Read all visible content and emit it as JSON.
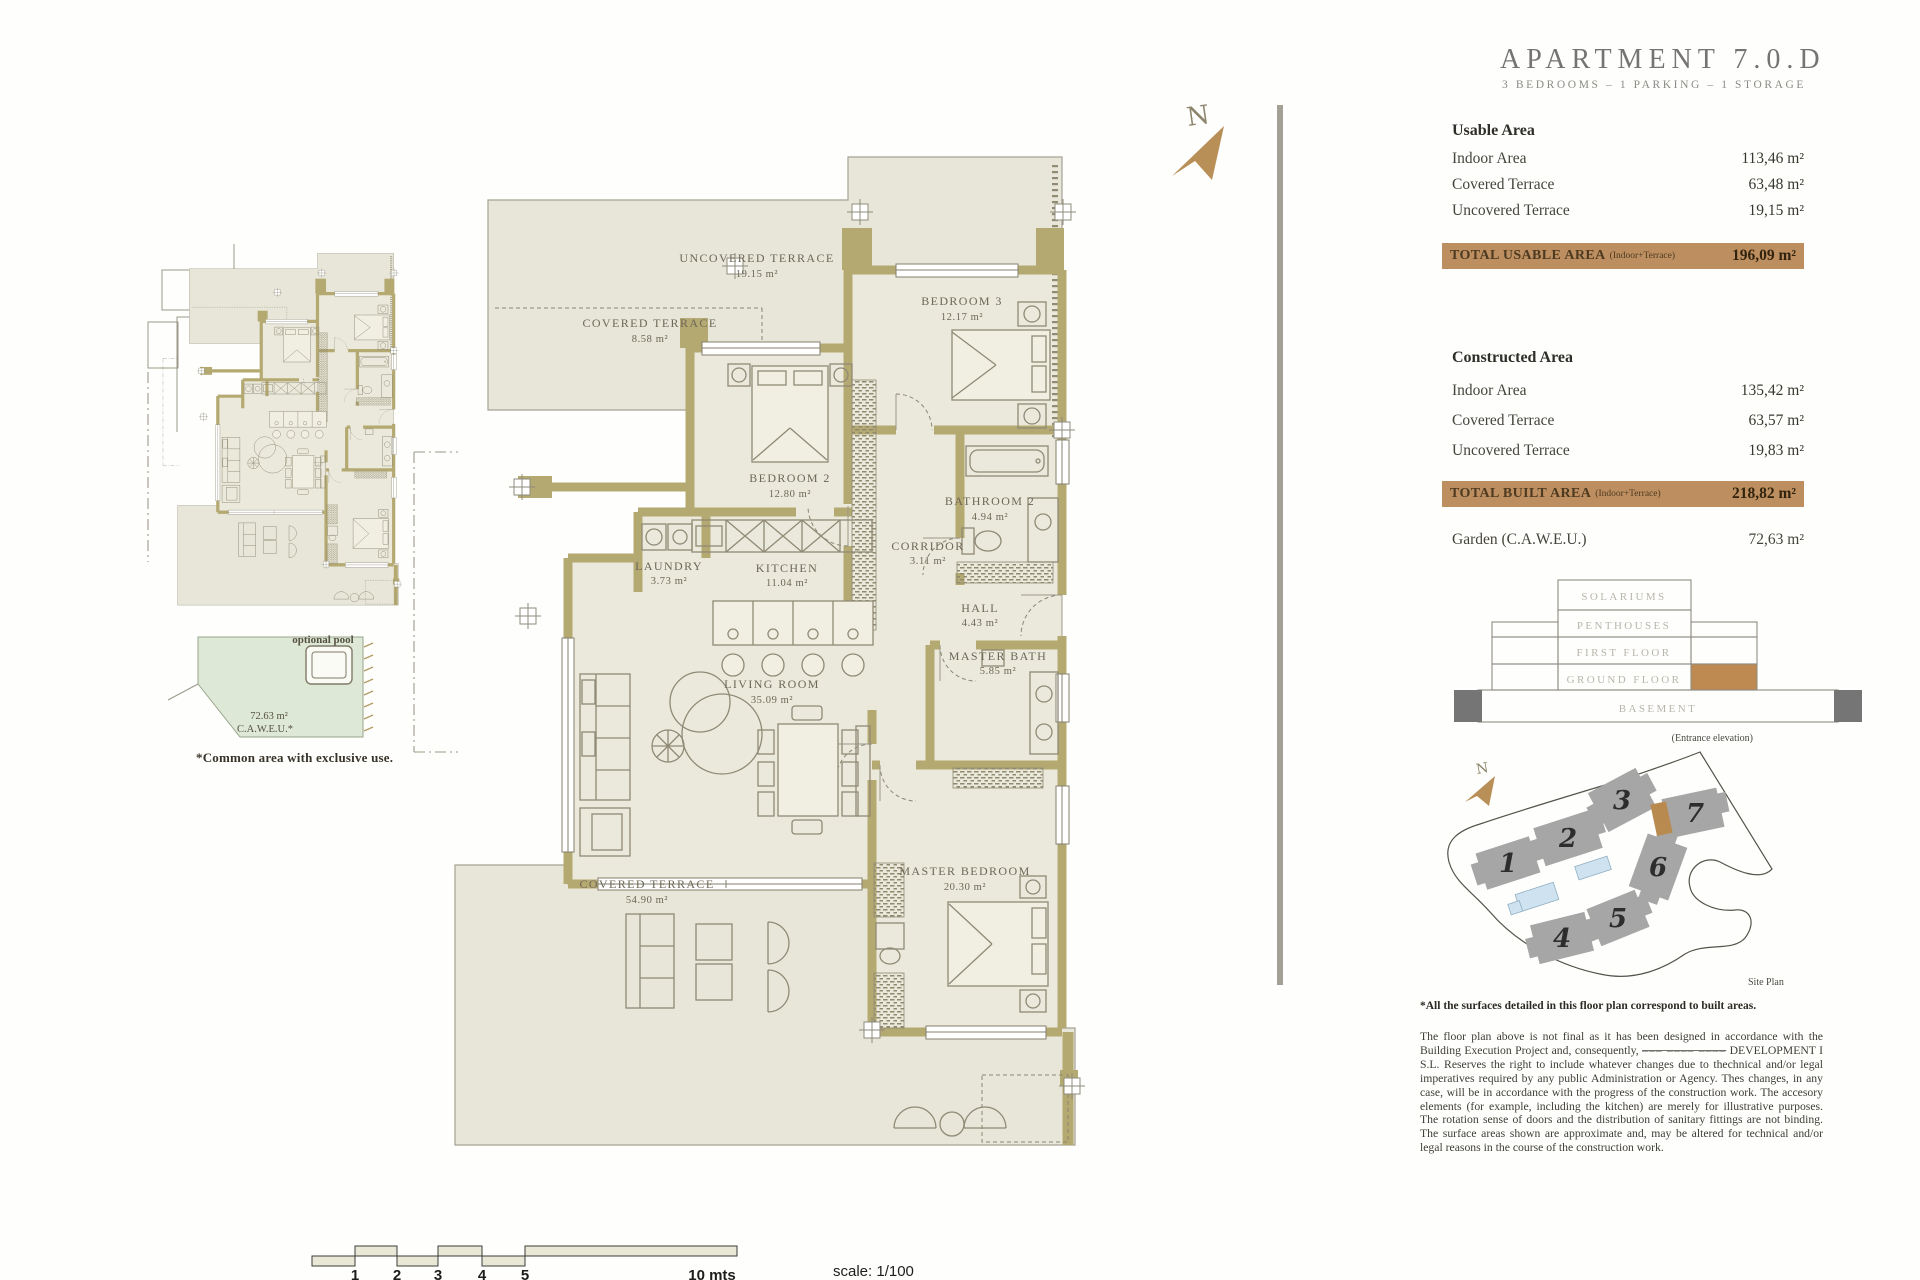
{
  "header": {
    "title": "APARTMENT 7.0.D",
    "subtitle": "3 BEDROOMS – 1 PARKING – 1 STORAGE"
  },
  "usable_area": {
    "heading": "Usable Area",
    "rows": [
      {
        "label": "Indoor Area",
        "value": "113,46 m²"
      },
      {
        "label": "Covered Terrace",
        "value": "63,48 m²"
      },
      {
        "label": "Uncovered Terrace",
        "value": "19,15 m²"
      }
    ],
    "total_label": "TOTAL USABLE AREA",
    "total_note": "(Indoor+Terrace)",
    "total_value": "196,09 m²"
  },
  "constructed_area": {
    "heading": "Constructed Area",
    "rows": [
      {
        "label": "Indoor Area",
        "value": "135,42 m²"
      },
      {
        "label": "Covered Terrace",
        "value": "63,57 m²"
      },
      {
        "label": "Uncovered Terrace",
        "value": "19,83 m²"
      }
    ],
    "total_label": "TOTAL BUILT AREA",
    "total_note": "(Indoor+Terrace)",
    "total_value": "218,82 m²",
    "garden_label": "Garden (C.A.W.E.U.)",
    "garden_value": "72,63 m²"
  },
  "elevation": {
    "floors": [
      "SOLARIUMS",
      "PENTHOUSES",
      "FIRST FLOOR",
      "GROUND FLOOR",
      "BASEMENT"
    ],
    "caption": "(Entrance elevation)"
  },
  "site_plan": {
    "label": "Site Plan",
    "buildings": [
      "1",
      "2",
      "3",
      "4",
      "5",
      "6",
      "7"
    ]
  },
  "footnote": "*All the surfaces detailed in this floor plan correspond to built areas.",
  "disclaimer": {
    "before": "The floor plan above is not final as it has been designed in accordance with the Building Execution Project and, consequently, ",
    "redacted": "––– –––– ––––",
    "after": " DEVELOPMENT I S.L. Reserves the right to include whatever changes due to thechnical and/or legal imperatives required by any public Administration or Agency. Thes changes, in any case, will be in accordance with the progress of the construction work. The accesory elements (for example, including the kitchen) are merely for illustrative purposes. The rotation sense of doors and the distribution of sanitary fittings are not binding. The surface areas shown are approximate and, may be altered for technical and/or legal reasons in the course of the construction work."
  },
  "plan": {
    "rooms": [
      {
        "name": "UNCOVERED TERRACE",
        "area": "19.15 m²"
      },
      {
        "name": "COVERED TERRACE",
        "area": "8.58 m²"
      },
      {
        "name": "BEDROOM 3",
        "area": "12.17 m²"
      },
      {
        "name": "BEDROOM 2",
        "area": "12.80 m²"
      },
      {
        "name": "BATHROOM 2",
        "area": "4.94 m²"
      },
      {
        "name": "CORRIDOR",
        "area": "3.11 m²"
      },
      {
        "name": "LAUNDRY",
        "area": "3.73 m²"
      },
      {
        "name": "KITCHEN",
        "area": "11.04 m²"
      },
      {
        "name": "HALL",
        "area": "4.43 m²"
      },
      {
        "name": "LIVING ROOM",
        "area": "35.09 m²"
      },
      {
        "name": "MASTER BATH",
        "area": "5.85 m²"
      },
      {
        "name": "MASTER BEDROOM",
        "area": "20.30 m²"
      },
      {
        "name": "COVERED TERRACE",
        "area": "54.90 m²"
      }
    ]
  },
  "mini_plan": {
    "pool_label": "optional pool",
    "garden_area": "72.63 m²",
    "garden_note": "C.A.W.E.U.*",
    "caption": "*Common area with exclusive use."
  },
  "scale_bar": {
    "ticks": [
      "1",
      "2",
      "3",
      "4",
      "5"
    ],
    "end_label": "10 mts",
    "scale_label": "scale: 1/100"
  },
  "compass": {
    "letter": "N"
  },
  "colors": {
    "accent_tan": "#bd8f60",
    "wall_khaki": "#b5a972",
    "site_highlight": "#b98a50",
    "pool_blue": "#cfe2ef"
  }
}
